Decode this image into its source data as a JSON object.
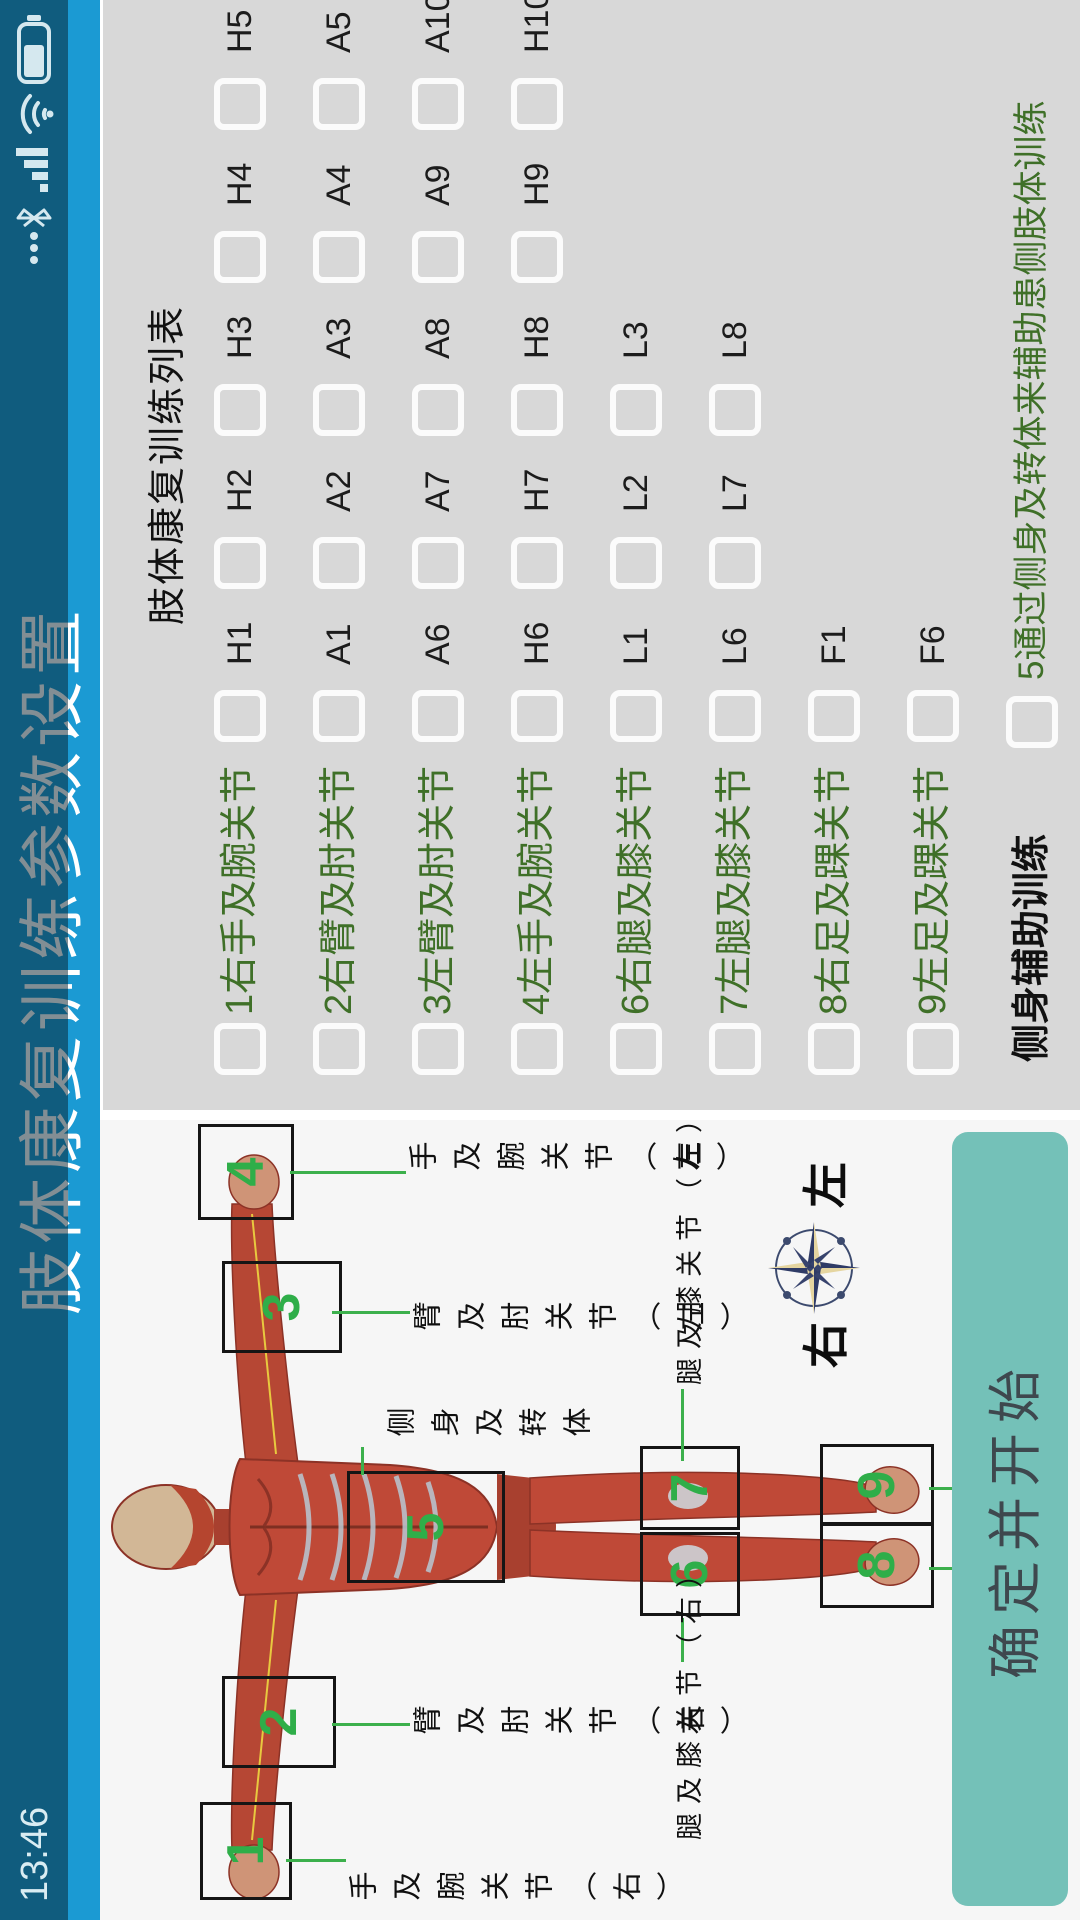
{
  "statusbar": {
    "time": "13:46",
    "icons": [
      "more-notifications-icon",
      "bluetooth-icon",
      "signal-icon",
      "wifi-icon",
      "battery-icon"
    ],
    "battery_fill": 0.55
  },
  "titlebar": {
    "title": "肢体康复训练参数设置"
  },
  "list": {
    "header": "肢体康复训练列表",
    "rows": [
      {
        "label": "1右手及腕关节",
        "items": [
          "H1",
          "H2",
          "H3",
          "H4",
          "H5"
        ]
      },
      {
        "label": "2右臂及肘关节",
        "items": [
          "A1",
          "A2",
          "A3",
          "A4",
          "A5"
        ]
      },
      {
        "label": "3左臂及肘关节",
        "items": [
          "A6",
          "A7",
          "A8",
          "A9",
          "A10"
        ]
      },
      {
        "label": "4左手及腕关节",
        "items": [
          "H6",
          "H7",
          "H8",
          "H9",
          "H10"
        ]
      },
      {
        "label": "6右腿及膝关节",
        "items": [
          "L1",
          "L2",
          "L3"
        ]
      },
      {
        "label": "7左腿及膝关节",
        "items": [
          "L6",
          "L7",
          "L8"
        ]
      },
      {
        "label": "8右足及踝关节",
        "items": [
          "F1"
        ]
      },
      {
        "label": "9左足及踝关节",
        "items": [
          "F6"
        ]
      }
    ],
    "side_assist": {
      "header": "侧身辅助训练",
      "label": "5通过侧身及转体来辅助患侧肢体训练"
    }
  },
  "anatomy": {
    "markers": [
      "1",
      "2",
      "3",
      "4",
      "5",
      "6",
      "7",
      "8",
      "9"
    ],
    "labels": [
      {
        "text": "手及腕关节（右）",
        "orient": "v"
      },
      {
        "text": "臂及肘关节（右）",
        "orient": "v"
      },
      {
        "text": "臂及肘关节（左）",
        "orient": "v"
      },
      {
        "text": "手及腕关节（左）",
        "orient": "v"
      },
      {
        "text": "侧身及转体",
        "orient": "v"
      },
      {
        "text": "腿及膝关节（右）",
        "orient": "h"
      },
      {
        "text": "腿及膝关节（左）",
        "orient": "h"
      },
      {
        "text": "足及踝关节（右）",
        "orient": "h"
      },
      {
        "text": "足及踝关节（左）",
        "orient": "h"
      }
    ],
    "compass": {
      "right": "右",
      "left": "左"
    }
  },
  "action_button": {
    "label": "确定并开始"
  },
  "colors": {
    "title_blue": "#1b9ad3",
    "status_overlay_blue": "#0e5470",
    "panel_gray": "#d8d8d8",
    "label_green": "#3f7028",
    "accent_green": "#2fae49",
    "button_teal": "#74c1b8",
    "muscle_red": "#bf4937"
  }
}
